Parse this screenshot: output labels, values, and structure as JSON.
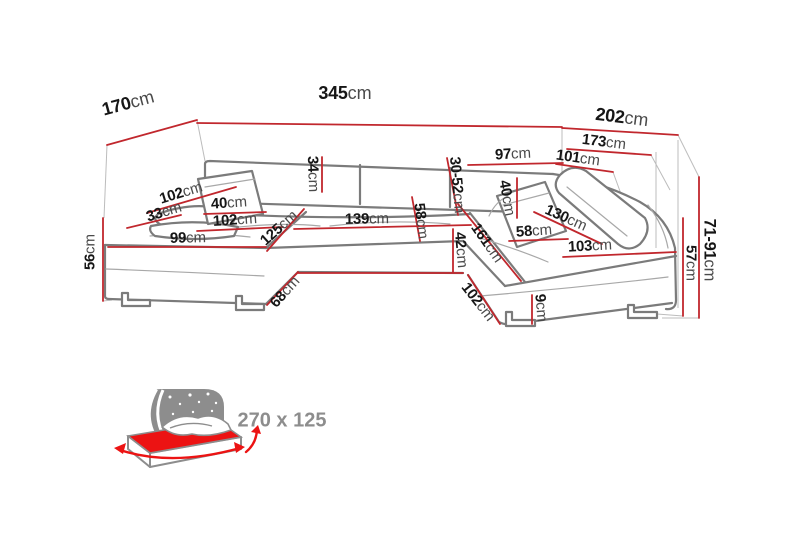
{
  "colors": {
    "background": "#ffffff",
    "dimension_line": "#c1272d",
    "outline": "#7b7b7b",
    "seam": "#a8a8a8",
    "guide": "#bcbcbc",
    "label_number": "#161616",
    "label_unit": "#4a4a4a",
    "icon_gray": "#8d8d8d",
    "mattress_red": "#ec1313"
  },
  "diagram": {
    "dims": {
      "d170": {
        "value": "170",
        "unit": "cm"
      },
      "d345": {
        "value": "345",
        "unit": "cm"
      },
      "d202": {
        "value": "202",
        "unit": "cm"
      },
      "d173": {
        "value": "173",
        "unit": "cm"
      },
      "d97": {
        "value": "97",
        "unit": "cm"
      },
      "d101": {
        "value": "101",
        "unit": "cm"
      },
      "d102_arm": {
        "value": "102",
        "unit": "cm"
      },
      "d33": {
        "value": "33",
        "unit": "cm"
      },
      "d40_left": {
        "value": "40",
        "unit": "cm"
      },
      "d102_seat": {
        "value": "102",
        "unit": "cm"
      },
      "d99": {
        "value": "99",
        "unit": "cm"
      },
      "d125": {
        "value": "125",
        "unit": "cm"
      },
      "d34": {
        "value": "34",
        "unit": "cm"
      },
      "d139": {
        "value": "139",
        "unit": "cm"
      },
      "d58_mid": {
        "value": "58",
        "unit": "cm"
      },
      "d30_52": {
        "value": "30-52",
        "unit": "cm"
      },
      "d42": {
        "value": "42",
        "unit": "cm"
      },
      "d161": {
        "value": "161",
        "unit": "cm"
      },
      "d58_right": {
        "value": "58",
        "unit": "cm"
      },
      "d40_right": {
        "value": "40",
        "unit": "cm"
      },
      "d130": {
        "value": "130",
        "unit": "cm"
      },
      "d103": {
        "value": "103",
        "unit": "cm"
      },
      "d68": {
        "value": "68",
        "unit": "cm"
      },
      "d102_bottom": {
        "value": "102",
        "unit": "cm"
      },
      "d9": {
        "value": "9",
        "unit": "cm"
      },
      "d71_91": {
        "value": "71-91",
        "unit": "cm"
      },
      "d57": {
        "value": "57",
        "unit": "cm"
      },
      "d56": {
        "value": "56",
        "unit": "cm"
      }
    }
  },
  "sleeping_function": {
    "size_label": "270 x 125"
  }
}
